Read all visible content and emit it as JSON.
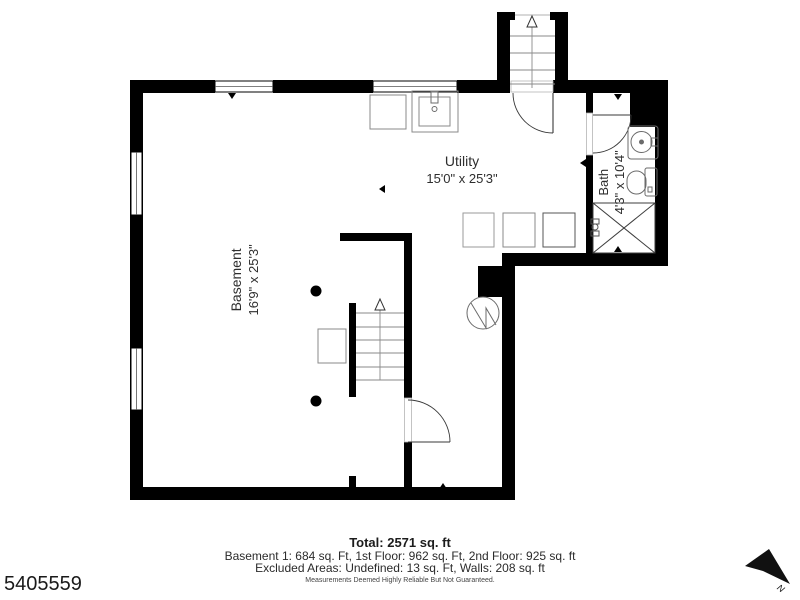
{
  "plan": {
    "rooms": {
      "utility": {
        "name": "Utility",
        "dims": "15'0\" x 25'3\""
      },
      "basement": {
        "name": "Basement",
        "dims": "16'9\" x 25'3\""
      },
      "bath": {
        "name": "Bath",
        "dims": "4'3\" x 10'4\""
      }
    },
    "footer": {
      "total": "Total: 2571 sq. ft",
      "floors": "Basement 1: 684 sq. Ft, 1st Floor: 962 sq. Ft, 2nd Floor: 925 sq. ft",
      "excluded": "Excluded Areas: Undefined: 13 sq. Ft, Walls: 208 sq. ft",
      "disclaimer": "Measurements Deemed Highly Reliable But Not Guaranteed."
    },
    "listing_id": "5405559",
    "compass_label": "N",
    "colors": {
      "wall": "#000000",
      "fixture": "#6b6b6b",
      "text": "#333333"
    },
    "icons": [
      "north-arrow-icon",
      "stairs-up-arrow-icon",
      "water-heater-icon",
      "toilet-icon",
      "sink-icon"
    ]
  }
}
